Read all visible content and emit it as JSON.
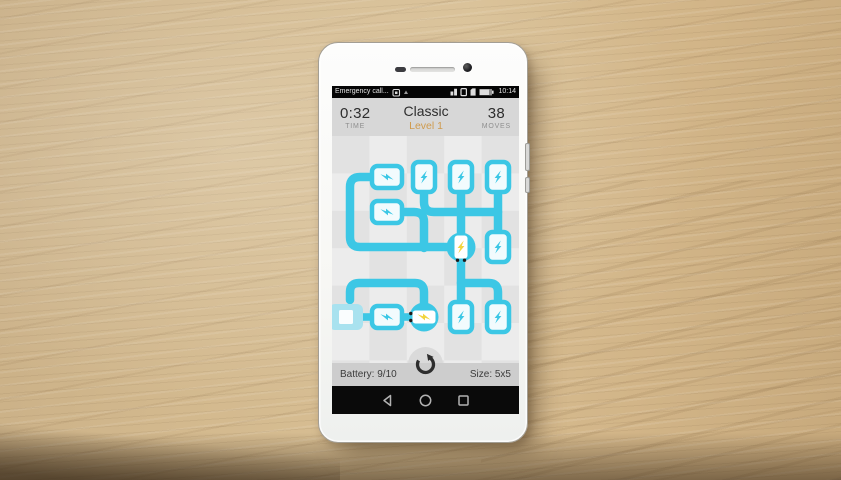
{
  "status_bar": {
    "left_text": "Emergency call...",
    "left_icon": "notification-icon",
    "right_icons": [
      "signal-icon",
      "sim-icon",
      "storage-icon",
      "battery-icon"
    ],
    "time": "10:14"
  },
  "header": {
    "time_value": "0:32",
    "time_label": "TIME",
    "mode_title": "Classic",
    "level_label": "Level 1",
    "moves_value": "38",
    "moves_label": "MOVES"
  },
  "footer": {
    "battery_label": "Battery: 9/10",
    "size_label": "Size: 5x5",
    "center_icon": "reload-icon"
  },
  "nav_bar": {
    "buttons": [
      "back",
      "home",
      "recents"
    ]
  },
  "colors": {
    "pipe_cyan": "#3cc7e5",
    "pipe_light_cyan": "#a9e2ef",
    "tile_fill": "#f2fbfd",
    "bolt_yellow": "#f2d53e",
    "terminal_black": "#1b1b1b",
    "level_text_orange": "#cf9b4e",
    "board_checker_light": "#ececec",
    "board_checker_dark": "#e2e2e2"
  },
  "board": {
    "grid_cols": 5,
    "grid_rows": 5,
    "pipes": [
      {
        "name": "pipe-left-loop",
        "d": "M 38 41 H 28 Q 18 41 18 51 V 101 Q 18 111 28 111 H 116"
      },
      {
        "name": "pipe-branch-r2c2",
        "d": "M 72 76 H 82 Q 92 76 92 86 V 112"
      },
      {
        "name": "pipe-r1c3-elbow",
        "d": "M 92 57 V 66 Q 92 76 102 76 H 129"
      },
      {
        "name": "pipe-r1c4-down",
        "d": "M 129 57 V 98"
      },
      {
        "name": "pipe-row2-right",
        "d": "M 129 76 H 166"
      },
      {
        "name": "pipe-r1c5-down",
        "d": "M 166 57 V 95"
      },
      {
        "name": "pipe-center-down",
        "d": "M 129 125 V 165"
      },
      {
        "name": "pipe-branch-row4",
        "d": "M 129 147 H 157 Q 166 147 166 156 V 165"
      },
      {
        "name": "pipe-arc-bottom",
        "d": "M 18 164 V 156 Q 18 147 27 147 H 83 Q 92 147 92 156 V 168"
      }
    ],
    "connectors": [
      {
        "x": 31,
        "y": 177.2,
        "w": 7.5,
        "h": 7.6
      },
      {
        "x": 71.5,
        "y": 177.2,
        "w": 7,
        "h": 7.6
      }
    ],
    "tiles": [
      {
        "name": "battery-tile-r1c2",
        "orient": "h",
        "x": 55,
        "y": 41,
        "state": "charged"
      },
      {
        "name": "battery-tile-r1c3",
        "orient": "v",
        "x": 92,
        "y": 41,
        "state": "charged"
      },
      {
        "name": "battery-tile-r1c4",
        "orient": "v",
        "x": 129,
        "y": 41,
        "state": "charged"
      },
      {
        "name": "battery-tile-r1c5",
        "orient": "v",
        "x": 166,
        "y": 41,
        "state": "charged"
      },
      {
        "name": "battery-tile-r2c2",
        "orient": "h",
        "x": 55,
        "y": 76,
        "state": "charged"
      },
      {
        "name": "battery-tile-r3c5",
        "orient": "v",
        "x": 166,
        "y": 111,
        "state": "charged"
      },
      {
        "name": "battery-tile-r5c1",
        "orient": "h",
        "x": 14,
        "y": 181,
        "state": "empty"
      },
      {
        "name": "battery-tile-r5c2",
        "orient": "h",
        "x": 55,
        "y": 181,
        "state": "charged"
      },
      {
        "name": "battery-tile-r5c4",
        "orient": "v",
        "x": 129,
        "y": 181,
        "state": "charged"
      },
      {
        "name": "battery-tile-r5c5",
        "orient": "v",
        "x": 166,
        "y": 181,
        "state": "charged"
      }
    ],
    "nodes": [
      {
        "name": "charger-node-center",
        "orient": "v",
        "x": 129,
        "y": 111
      },
      {
        "name": "charger-node-bottom",
        "orient": "h",
        "x": 92,
        "y": 181
      }
    ]
  }
}
